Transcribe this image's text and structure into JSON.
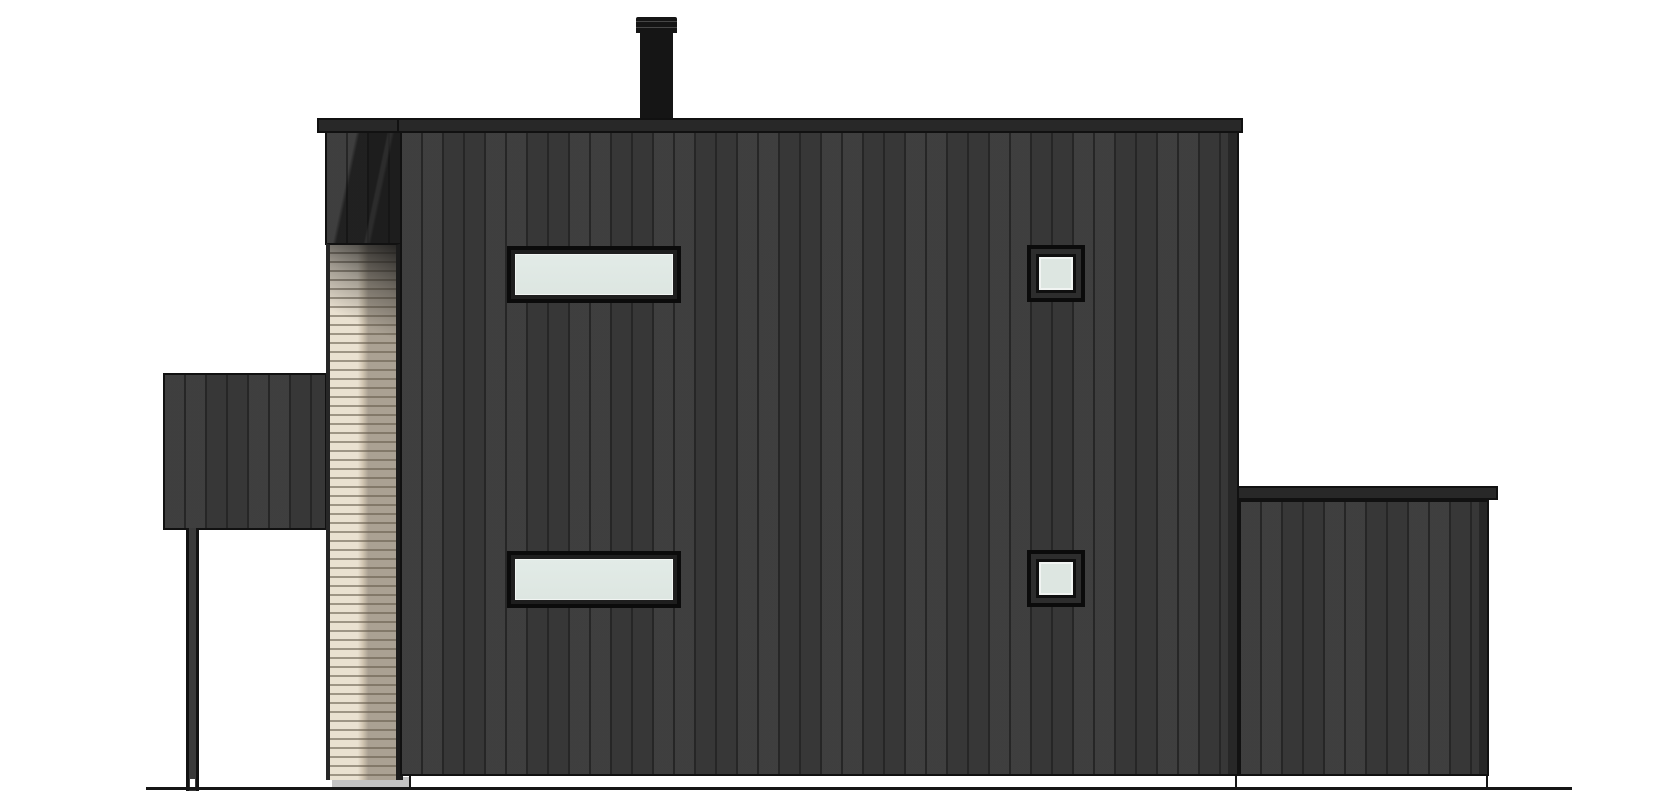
{
  "page": {
    "kind": "architectural side elevation drawing",
    "subject": "two-storey house with dark vertical board cladding, recessed wood-slat strip, carport canopy and lower annex"
  },
  "colors": {
    "background": "#ffffff",
    "wall_board": "#3a3a3a",
    "wall_batten": "#262626",
    "outline": "#111111",
    "roof": "#282828",
    "chimney": "#151515",
    "slat_cream": "#eae1d1",
    "slat_taupe": "#aaa193",
    "window_frame": "#0b0b0b",
    "window_frame_inner": "#2d2d2d",
    "glass": "#dde6e1",
    "glass_frame": "#f1f4f2",
    "foundation": "#c3c3c3",
    "ground": "#161616"
  },
  "scene": {
    "elements": [
      "chimney",
      "main-roof-cap",
      "upper-left-wall-section",
      "slat-entry-strip",
      "main-wall",
      "annex-roof-cap",
      "annex-wall",
      "carport-canopy",
      "carport-post",
      "window-upper-left",
      "window-lower-left",
      "window-upper-right",
      "window-lower-right",
      "foundation-strip",
      "ground-line"
    ]
  }
}
